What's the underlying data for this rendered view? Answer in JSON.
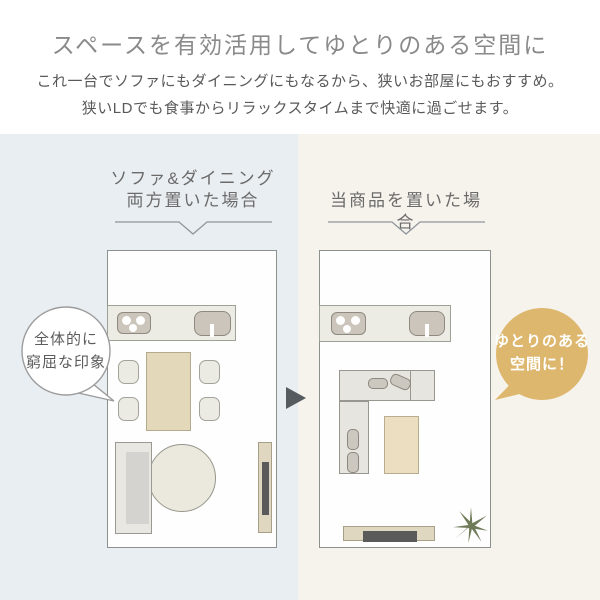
{
  "header": {
    "title": "スペースを有効活用してゆとりのある空間に",
    "subtitle_line1": "これ一台でソファにもダイニングにもなるから、狭いお部屋にもおすすめ。",
    "subtitle_line2": "狭いLDでも食事からリラックスタイムまで快適に過ごせます。"
  },
  "before_panel": {
    "heading_line1": "ソファ&ダイニング",
    "heading_line2": "両方置いた場合",
    "bubble_line1": "全体的に",
    "bubble_line2": "窮屈な印象"
  },
  "after_panel": {
    "heading": "当商品を置いた場合",
    "bubble_line1": "ゆとりのある",
    "bubble_line2": "空間に！"
  },
  "icons": {
    "arrow_right": "right-pointing-triangle",
    "plant": "top-view-plant-asterisk"
  },
  "colors": {
    "before_panel_bg": "#e9eef2",
    "after_panel_bg": "#f6f3ec",
    "accent_gold": "#deb76e",
    "bubble_text_white": "#ffffff",
    "plant_green": "#6f7b58",
    "arrow_gray": "#565b60",
    "title_gray": "#8a8a8a",
    "body_text_gray": "#595959",
    "floorplan_line": "#8d918d"
  }
}
